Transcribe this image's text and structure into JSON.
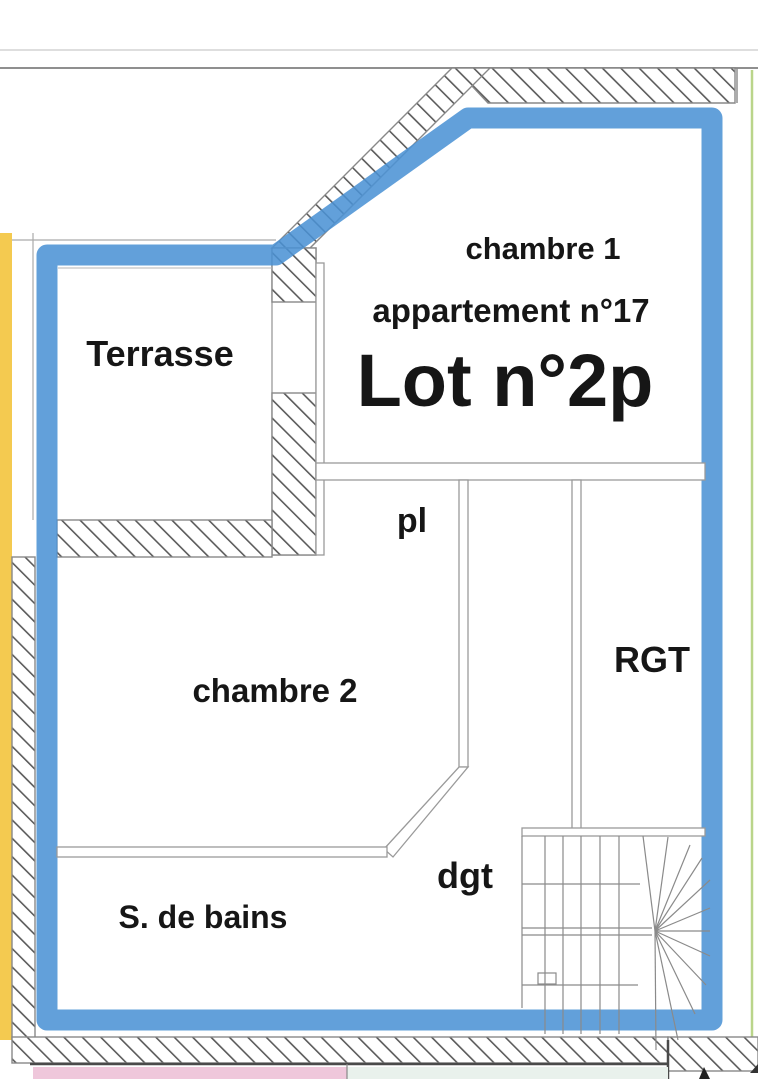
{
  "plan": {
    "labels": {
      "chambre1": "chambre 1",
      "appartement": "appartement n°17",
      "lot": "Lot n°2p",
      "terrasse": "Terrasse",
      "pl": "pl",
      "chambre2": "chambre 2",
      "rgt": "RGT",
      "dgt": "dgt",
      "s_de_bains": "S. de bains"
    },
    "colors": {
      "highlight_blue": "#4b92d4",
      "yellow_strip": "#f4ca50",
      "pink_strip": "#efc7db",
      "pale_green_strip": "#e9f1ec",
      "green_boundary": "#a9cb6e",
      "hatch_line": "#5a5a5a",
      "wall_line": "#9a9a9a",
      "text": "#161616"
    }
  }
}
